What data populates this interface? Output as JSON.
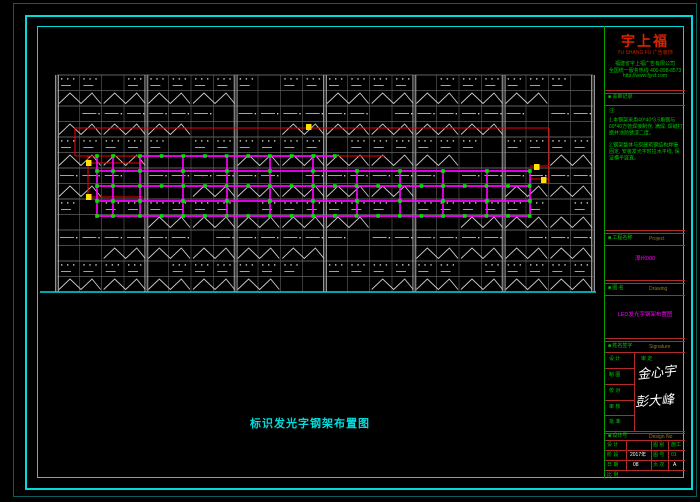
{
  "window": {
    "bg": "#000000"
  },
  "caption": {
    "text": "标识发光字钢架布置图"
  },
  "title_block": {
    "logo": {
      "main": "宇上福",
      "sub": "YU SHANG FU  广告装饰"
    },
    "company_lines": [
      "福建省宇上福广告有限公司",
      "全国统一服务热线  400-898-8573",
      "http://www.fjysf.com"
    ],
    "review_label": "■ 会审记录",
    "notes_title": "注:",
    "notes": [
      "1.本钢架采用40*40*3.5角钢与60*40方管焊接制作, 满焊, 焊缝打磨并涂防锈漆二度。",
      "2.钢架整体与原建筑钢结构焊接固定, 安装发光字时拉水平线, 保证横平竖直。"
    ],
    "project_label": "■ 工程名称",
    "project_sub": "Project",
    "project_value": "漳州000",
    "drawing_label": "■ 图  名",
    "drawing_sub": "Drawing",
    "drawing_value": "LED发光字钢架布置图",
    "sign_label": "■ 姓名签字",
    "sign_sub": "Signature",
    "sign_rows": [
      {
        "label": "设  计"
      },
      {
        "label": "制  图"
      },
      {
        "label": "校  对"
      },
      {
        "label": "审  核"
      },
      {
        "label": "批  准"
      }
    ],
    "sign_right_label": "审  定",
    "signature1": "金心宇",
    "signature2": "彭大峰",
    "designno_label": "■ 设计号",
    "designno_sub": "Design No",
    "table": {
      "rows": [
        [
          "设  计",
          "",
          "图  别",
          "施工"
        ],
        [
          "阶  段",
          "2017年",
          "图  号",
          "01"
        ],
        [
          "日  期",
          "08",
          "页  次",
          "A"
        ]
      ],
      "bottom_label": "比  例"
    }
  },
  "drawing": {
    "x": 57,
    "y": 75,
    "w": 536,
    "h": 217,
    "rows": 14,
    "majors": 6,
    "subs": 4,
    "colors": {
      "line": "#616161",
      "bright": "#cdcdcd",
      "col": "#9b9b9b",
      "red": "#f00000",
      "magenta": "#ff00ff",
      "green": "#00e000",
      "yellow": "#ffe000",
      "cyan": "#00dcdc"
    },
    "red_segments": [
      [
        75,
        128,
        549,
        128
      ],
      [
        75,
        128,
        75,
        156
      ],
      [
        549,
        128,
        549,
        183
      ],
      [
        75,
        156,
        385,
        156
      ],
      [
        88,
        156,
        88,
        197
      ],
      [
        88,
        163,
        143,
        163
      ],
      [
        88,
        197,
        143,
        197
      ],
      [
        530,
        166,
        549,
        166
      ],
      [
        530,
        179,
        549,
        179
      ]
    ],
    "magenta_h": [
      [
        140,
        156,
        335,
        156
      ],
      [
        97,
        171,
        530,
        171
      ],
      [
        97,
        186,
        530,
        186
      ],
      [
        97,
        201,
        530,
        201
      ],
      [
        97,
        216,
        530,
        216
      ]
    ],
    "magenta_v": {
      "xs": [
        97,
        113,
        140,
        183,
        227,
        270,
        313,
        357,
        400,
        443,
        487,
        530
      ],
      "top_cut": 335,
      "y_top": 156,
      "y_mid": 171,
      "y_bot": 216
    },
    "nodes": {
      "dense_rows": [
        156,
        186,
        216
      ],
      "sparse_rows": [
        171,
        201
      ],
      "dense_from": 140,
      "dense_to": 530,
      "dense_step": 21.65,
      "extra_xs": [
        97,
        113
      ]
    },
    "baseline": [
      40,
      292,
      596,
      292
    ],
    "yellow_markers": [
      [
        86,
        160
      ],
      [
        86,
        194
      ],
      [
        306,
        124
      ],
      [
        534,
        164
      ],
      [
        541,
        177
      ]
    ]
  }
}
